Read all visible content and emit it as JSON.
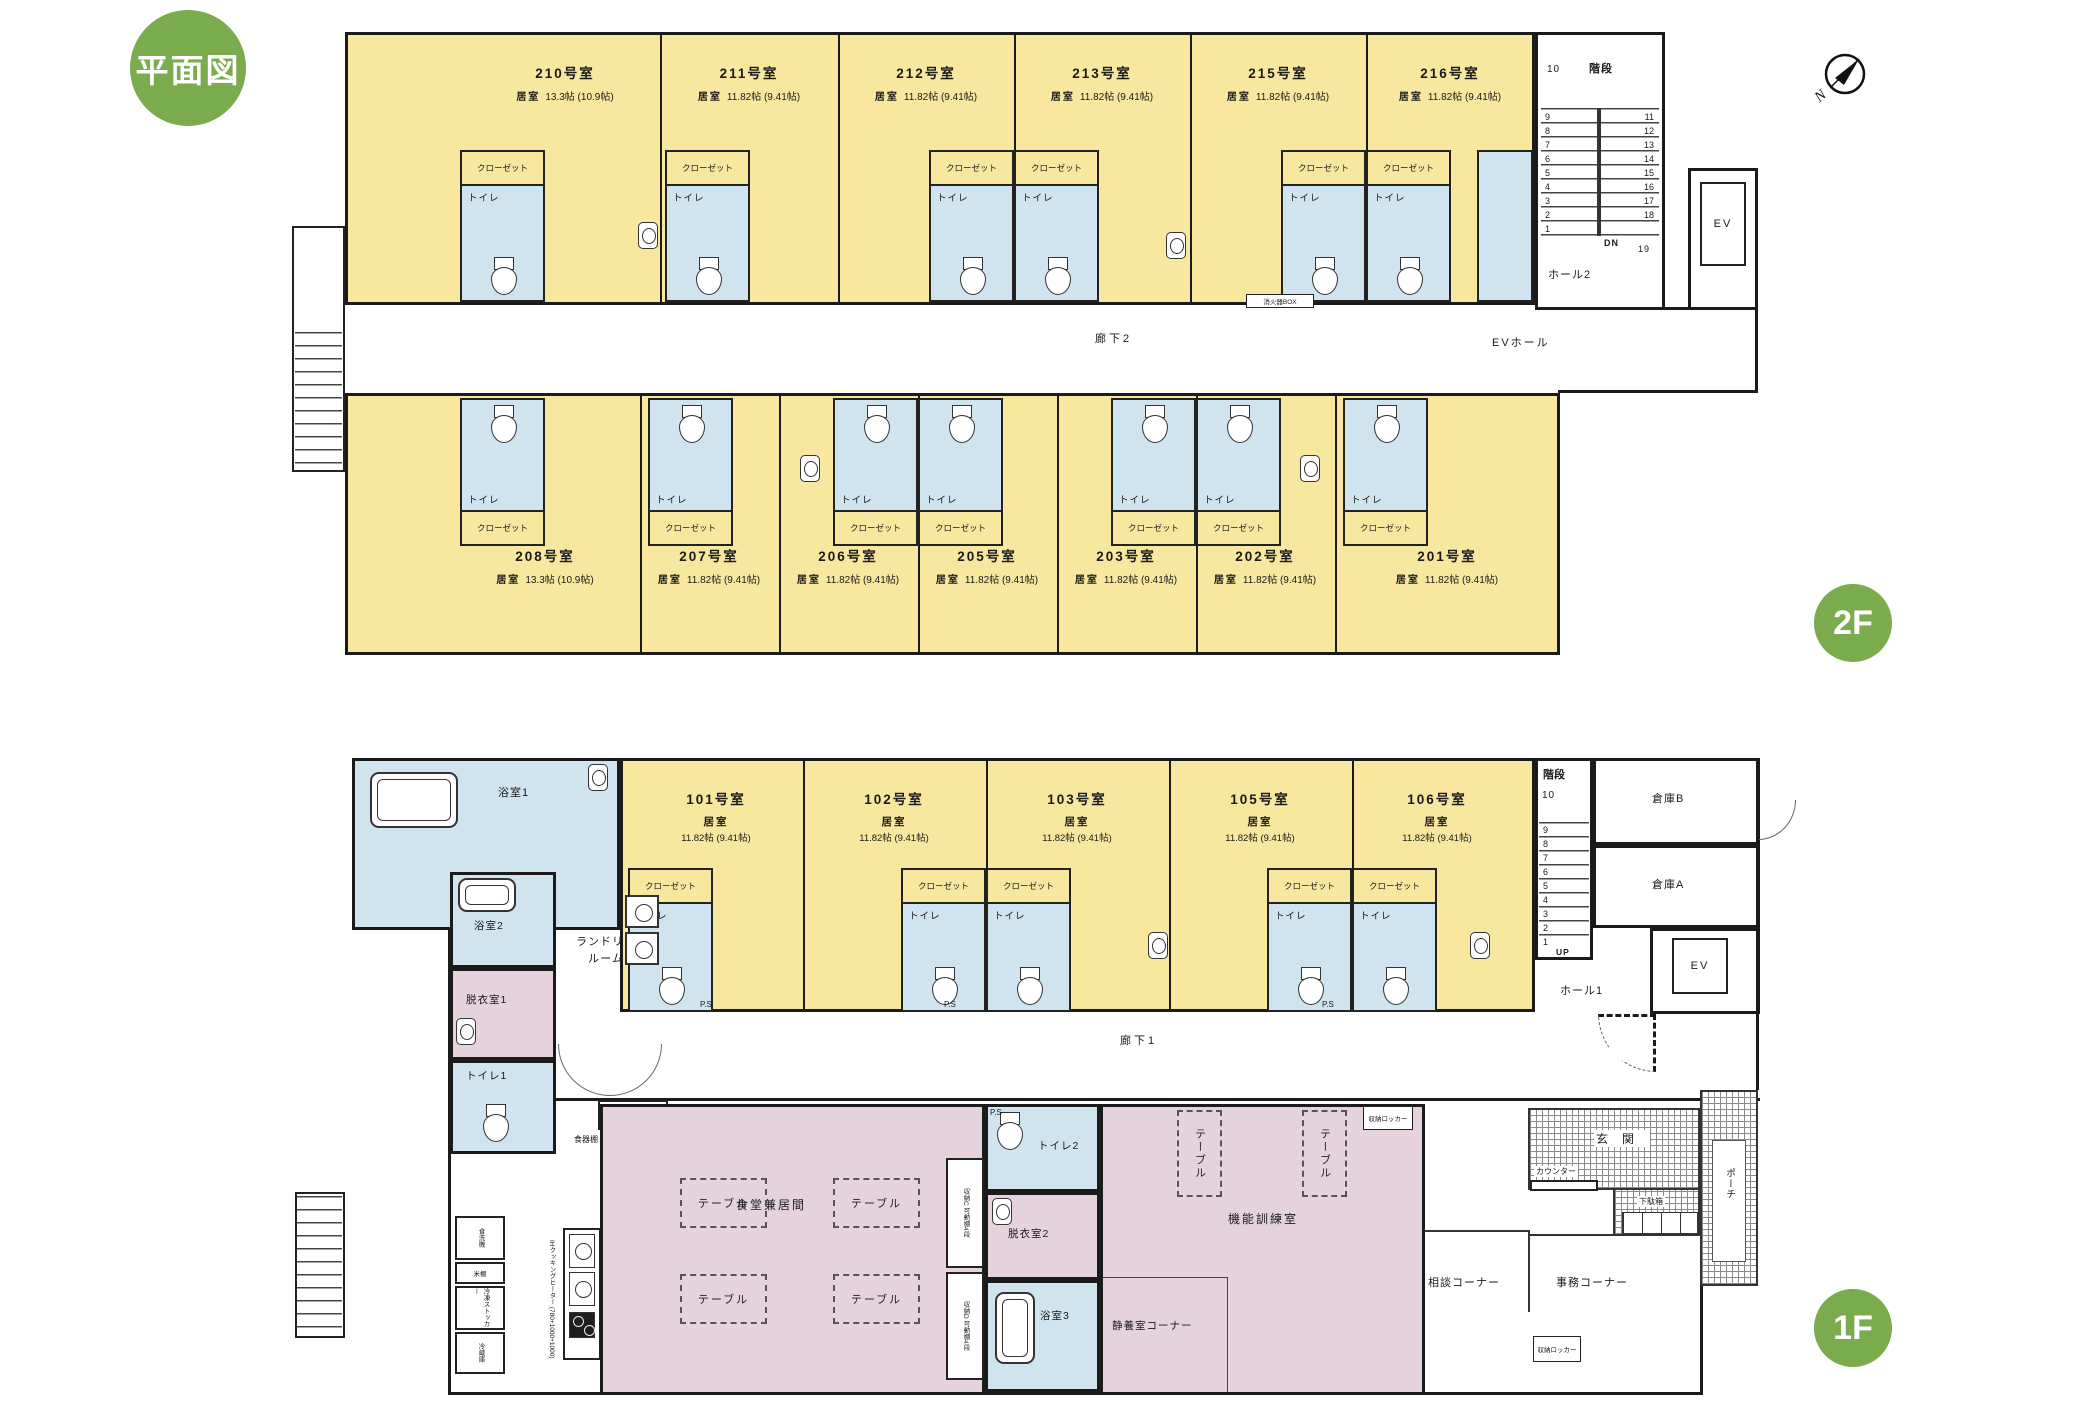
{
  "badges": {
    "title": "平面図",
    "floor2": "2F",
    "floor1": "1F"
  },
  "compass": {
    "north": "N"
  },
  "labels": {
    "closet": "クローゼット",
    "toilet": "トイレ",
    "room_type": "居室",
    "ps": "P.S",
    "extinguisher": "消火器BOX",
    "table": "テーブル"
  },
  "floor2": {
    "corridor": "廊下2",
    "ev_hall": "EVホール",
    "hall": "ホール2",
    "ev": "EV",
    "stairs": {
      "title": "階段",
      "top": "10",
      "left_numbers": "9\n8\n7\n6\n5\n4\n3\n2\n1",
      "right_numbers": "11\n12\n13\n14\n15\n16\n17\n18",
      "dn": "DN",
      "last": "19"
    },
    "top_rooms": [
      {
        "number": "210号室",
        "size": "13.3帖 (10.9帖)"
      },
      {
        "number": "211号室",
        "size": "11.82帖 (9.41帖)"
      },
      {
        "number": "212号室",
        "size": "11.82帖 (9.41帖)"
      },
      {
        "number": "213号室",
        "size": "11.82帖 (9.41帖)"
      },
      {
        "number": "215号室",
        "size": "11.82帖 (9.41帖)"
      },
      {
        "number": "216号室",
        "size": "11.82帖 (9.41帖)"
      }
    ],
    "bottom_rooms": [
      {
        "number": "208号室",
        "size": "13.3帖 (10.9帖)"
      },
      {
        "number": "207号室",
        "size": "11.82帖 (9.41帖)"
      },
      {
        "number": "206号室",
        "size": "11.82帖 (9.41帖)"
      },
      {
        "number": "205号室",
        "size": "11.82帖 (9.41帖)"
      },
      {
        "number": "203号室",
        "size": "11.82帖 (9.41帖)"
      },
      {
        "number": "202号室",
        "size": "11.82帖 (9.41帖)"
      },
      {
        "number": "201号室",
        "size": "11.82帖 (9.41帖)"
      }
    ]
  },
  "floor1": {
    "corridor": "廊下1",
    "hall": "ホール1",
    "ev": "EV",
    "storage_a": "倉庫A",
    "storage_b": "倉庫B",
    "stairs": {
      "title": "階段",
      "top": "10",
      "left_numbers": "9\n8\n7\n6\n5\n4\n3\n2\n1",
      "up": "UP"
    },
    "rooms": [
      {
        "number": "101号室",
        "size": "11.82帖 (9.41帖)"
      },
      {
        "number": "102号室",
        "size": "11.82帖 (9.41帖)"
      },
      {
        "number": "103号室",
        "size": "11.82帖 (9.41帖)"
      },
      {
        "number": "105号室",
        "size": "11.82帖 (9.41帖)"
      },
      {
        "number": "106号室",
        "size": "11.82帖 (9.41帖)"
      }
    ],
    "bath1": "浴室1",
    "bath2": "浴室2",
    "bath3": "浴室3",
    "laundry": "ランドリー\nルーム",
    "dressing1": "脱衣室1",
    "dressing2": "脱衣室2",
    "toilet1": "トイレ1",
    "toilet2": "トイレ2",
    "dining": "食堂兼居間",
    "training": "機能訓練室",
    "rest_corner": "静養室コーナー",
    "consult_corner": "相談コーナー",
    "office_corner": "事務コーナー",
    "entrance": "玄関",
    "porch": "ポーチ",
    "counter": "カウンター",
    "shoe_box": "下駄箱",
    "locker": "収納ロッカー",
    "storage_c": "収納C 可動棚4段",
    "storage_d": "収納D 可動棚4段",
    "storage_e": "収納E",
    "cupboard": "食器棚",
    "dishwasher": "食洗機",
    "rice_shelf": "米棚",
    "freezer": "冷凍ストッカー",
    "fridge": "冷蔵庫",
    "ih": "IHクッキングヒーター (780+1000+1000)"
  }
}
